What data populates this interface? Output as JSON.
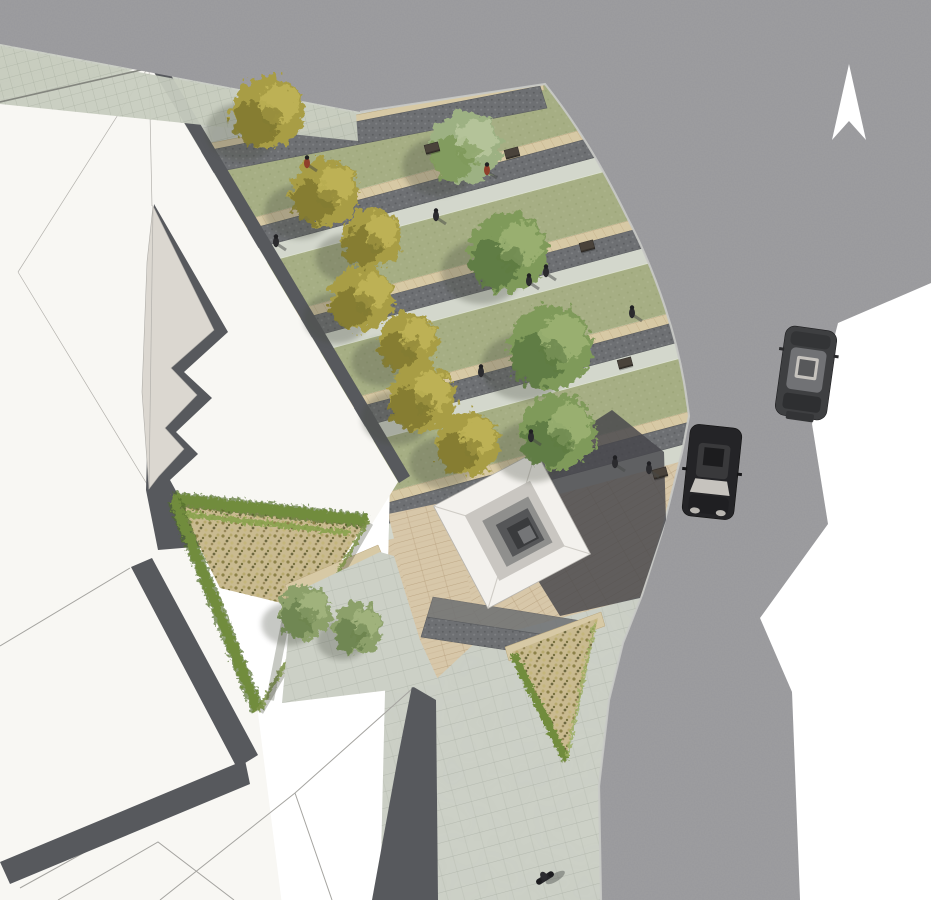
{
  "meta": {
    "title": "Aerial site-plan rendering",
    "description": "Top-down architectural rendering of a corner plaza: white buildings with cast shadows, four lawn strips with autumn and green trees, travertine seat bands and cobble walks, a stepped pyramid skylight monument on a timber deck, two triangular dry-planting beds with hedges, a curving asphalt road with two cars, a motorcyclist and a white north arrow"
  },
  "colors": {
    "background": "#ffffff",
    "road": "#98989b",
    "roadCurb": "#c9cac6",
    "plaza": "#cdd1c7",
    "sidewalk": "#c7ccbf",
    "paverLight": "#d3d7cc",
    "cobble": "#6e7073",
    "cobbleEdge": "#595b5e",
    "lawn": "#a6ae84",
    "travertine": "#d7c9a5",
    "wood": "#d7c7a9",
    "scrub": "#c9ba90",
    "hedge": "#718c3d",
    "hedgeDark": "#4f6a2a",
    "treeAutumn": "#a89d45",
    "treeAutumnDark": "#827a31",
    "treeAutumnLight": "#c1b557",
    "treeGreen": "#7f9a5a",
    "treeGreenDark": "#5e7a42",
    "treeGreenLight": "#9db374",
    "treePale": "#9db183",
    "canopyShadow": "#464c40",
    "buildingWhite": "#f8f7f3",
    "buildingLine": "#a5a4a0",
    "buildingShadow": "#57595d",
    "roof": "#dbd7d0",
    "pyramidFace": "#f3f1ed",
    "pyramidSeam": "#cfccc6",
    "pyramidRing1": "#c9c6c1",
    "pyramidRing2": "#8f8f8d",
    "pyramidRing3": "#555658",
    "pyramidCore": "#3a3b3d",
    "pyramidMid": "#747577",
    "pyramidShadow": "#45464b",
    "carBody": "#3e3f41",
    "carBody2": "#242427",
    "carRoof": "#717275",
    "carGlass": "#c6c3be",
    "bench": "#4a433b",
    "person": "#2b2b2e",
    "personRed": "#8f3f2b",
    "arrow": "#ffffff"
  },
  "scene": {
    "north_arrow": {
      "points": "849,64 866,140 849,121 832,140"
    },
    "cars": [
      {
        "type": "suv-heading-north",
        "transform": "translate(806,373) rotate(8)"
      },
      {
        "type": "sedan-heading-south",
        "transform": "translate(712,472) rotate(6)"
      }
    ],
    "motorcycle": {
      "transform": "translate(545,878) rotate(-32)"
    },
    "lawn_strips": 4,
    "planting_beds": 2,
    "trees": [
      {
        "x": 268,
        "y": 112,
        "r": 36,
        "k": "autumn"
      },
      {
        "x": 325,
        "y": 192,
        "r": 34,
        "k": "autumn"
      },
      {
        "x": 372,
        "y": 238,
        "r": 30,
        "k": "autumn"
      },
      {
        "x": 362,
        "y": 298,
        "r": 32,
        "k": "autumn"
      },
      {
        "x": 408,
        "y": 342,
        "r": 30,
        "k": "autumn"
      },
      {
        "x": 422,
        "y": 398,
        "r": 34,
        "k": "autumn"
      },
      {
        "x": 468,
        "y": 443,
        "r": 32,
        "k": "autumn"
      },
      {
        "x": 465,
        "y": 147,
        "r": 36,
        "k": "pale"
      },
      {
        "x": 508,
        "y": 252,
        "r": 40,
        "k": "green"
      },
      {
        "x": 550,
        "y": 347,
        "r": 42,
        "k": "green"
      },
      {
        "x": 558,
        "y": 432,
        "r": 38,
        "k": "green"
      }
    ],
    "shrubs": [
      {
        "x": 305,
        "y": 612,
        "r": 27,
        "k": "shrub"
      },
      {
        "x": 358,
        "y": 628,
        "r": 25,
        "k": "shrub"
      }
    ],
    "people": [
      {
        "x": 276,
        "y": 242
      },
      {
        "x": 436,
        "y": 216
      },
      {
        "x": 307,
        "y": 163,
        "red": true
      },
      {
        "x": 487,
        "y": 170,
        "red": true
      },
      {
        "x": 529,
        "y": 281
      },
      {
        "x": 546,
        "y": 272
      },
      {
        "x": 632,
        "y": 313
      },
      {
        "x": 481,
        "y": 372
      },
      {
        "x": 531,
        "y": 437
      },
      {
        "x": 615,
        "y": 463
      },
      {
        "x": 649,
        "y": 469
      }
    ],
    "benches": [
      {
        "x": 432,
        "y": 148
      },
      {
        "x": 512,
        "y": 153
      },
      {
        "x": 587,
        "y": 246
      },
      {
        "x": 625,
        "y": 363
      },
      {
        "x": 660,
        "y": 473
      }
    ]
  }
}
